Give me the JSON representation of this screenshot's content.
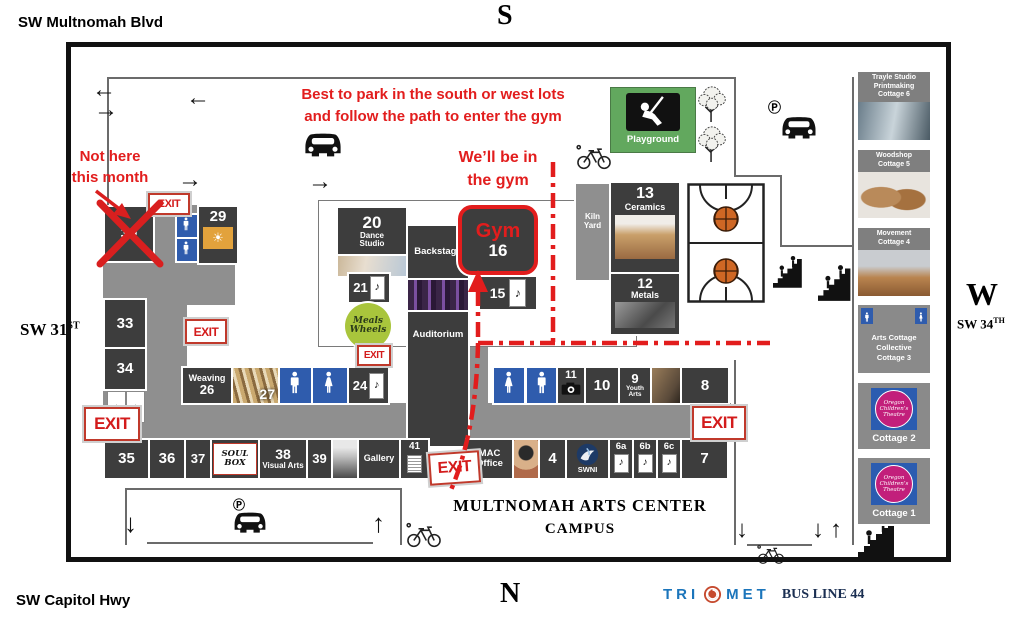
{
  "compass": {
    "top": "S",
    "bottom": "N",
    "left": "E",
    "right": "W"
  },
  "streets": {
    "top": "SW Multnomah Blvd",
    "bottom": "SW Capitol Hwy",
    "left_main": "SW 31",
    "left_sup": "ST",
    "right_main": "SW 34",
    "right_sup": "TH"
  },
  "annotations": {
    "park_line1": "Best to park in the south or west lots",
    "park_line2": "and follow the path to enter the gym",
    "gym_line1": "We’ll be in",
    "gym_line2": "the gym",
    "nothere_line1": "Not here",
    "nothere_line2": "this month"
  },
  "exit_label": "EXIT",
  "campus_title": {
    "line1": "MULTNOMAH ARTS CENTER",
    "line2": "CAMPUS"
  },
  "transit": {
    "brand_tri": "TRI",
    "brand_met": "MET",
    "bus_line": "BUS LINE 44"
  },
  "icons": {
    "arrow_left": "←",
    "arrow_right": "→",
    "arrow_up": "↑",
    "arrow_down": "↓",
    "parking": "Ⓟ",
    "music_note": "♪",
    "sun": "☀"
  },
  "rooms": {
    "r30": {
      "num": "30"
    },
    "r29": {
      "num": "29"
    },
    "r33": {
      "num": "33"
    },
    "r34": {
      "num": "34"
    },
    "r20": {
      "num": "20",
      "name_line1": "Dance",
      "name_line2": "Studio"
    },
    "r21": {
      "num": "21"
    },
    "backstage": {
      "name": "Backstage"
    },
    "auditorium": {
      "name": "Auditorium"
    },
    "gym": {
      "name": "Gym",
      "num": "16"
    },
    "r15": {
      "num": "15"
    },
    "weaving": {
      "name": "Weaving",
      "num": "26"
    },
    "r27": {
      "num": "27"
    },
    "r24": {
      "num": "24"
    },
    "kiln": {
      "name_line1": "Kiln",
      "name_line2": "Yard"
    },
    "ceramics": {
      "num": "13",
      "name": "Ceramics"
    },
    "metals": {
      "num": "12",
      "name": "Metals"
    },
    "playground": {
      "name": "Playground"
    },
    "r11": {
      "num": "11"
    },
    "r10": {
      "num": "10"
    },
    "r9": {
      "num": "9",
      "name_line1": "Youth",
      "name_line2": "Arts"
    },
    "r8": {
      "num": "8"
    },
    "r35": {
      "num": "35"
    },
    "r36": {
      "num": "36"
    },
    "r37": {
      "num": "37"
    },
    "soulbox": {
      "name": "SOUL BOX"
    },
    "r38": {
      "num": "38",
      "name": "Visual Arts"
    },
    "r39": {
      "num": "39"
    },
    "gallery": {
      "name": "Gallery"
    },
    "r41": {
      "num": "41"
    },
    "mac": {
      "name_line1": "MAC",
      "name_line2": "Office"
    },
    "r4": {
      "num": "4"
    },
    "swni": {
      "name": "SWNI"
    },
    "r6a": {
      "num": "6a"
    },
    "r6b": {
      "num": "6b"
    },
    "r6c": {
      "num": "6c"
    },
    "r7": {
      "num": "7"
    }
  },
  "cottages": {
    "c6": {
      "line1": "Trayle Studio",
      "line2": "Printmaking",
      "line3": "Cottage 6"
    },
    "c5": {
      "line1": "Woodshop",
      "line2": "Cottage 5"
    },
    "c4": {
      "line1": "Movement",
      "line2": "Cottage 4"
    },
    "c3": {
      "line1": "Arts Cottage",
      "line2": "Collective",
      "line3": "Cottage 3"
    },
    "c2": {
      "label": "Cottage 2"
    },
    "c1": {
      "label": "Cottage 1"
    }
  },
  "logos": {
    "meals_line1": "Meals",
    "meals_line2": "Wheels",
    "oct_line1": "Oregon",
    "oct_line2": "Children’s",
    "oct_line3": "Theatre"
  },
  "colors": {
    "room_dark": "#3d3d3d",
    "corridor_gray": "#8f8f8f",
    "accent_red": "#e21d1d",
    "restroom_blue": "#2f5cad",
    "playground_green": "#62a85e",
    "logo29_orange": "#e2a23c",
    "meals_green": "#a9c53c",
    "swni_navy": "#1d3a66",
    "oct_pink": "#c21f7b",
    "oct_blue": "#2b5cb0",
    "trimet_blue": "#1b75bb",
    "trimet_orange": "#c64a2e",
    "busline_navy": "#1b2f52"
  }
}
